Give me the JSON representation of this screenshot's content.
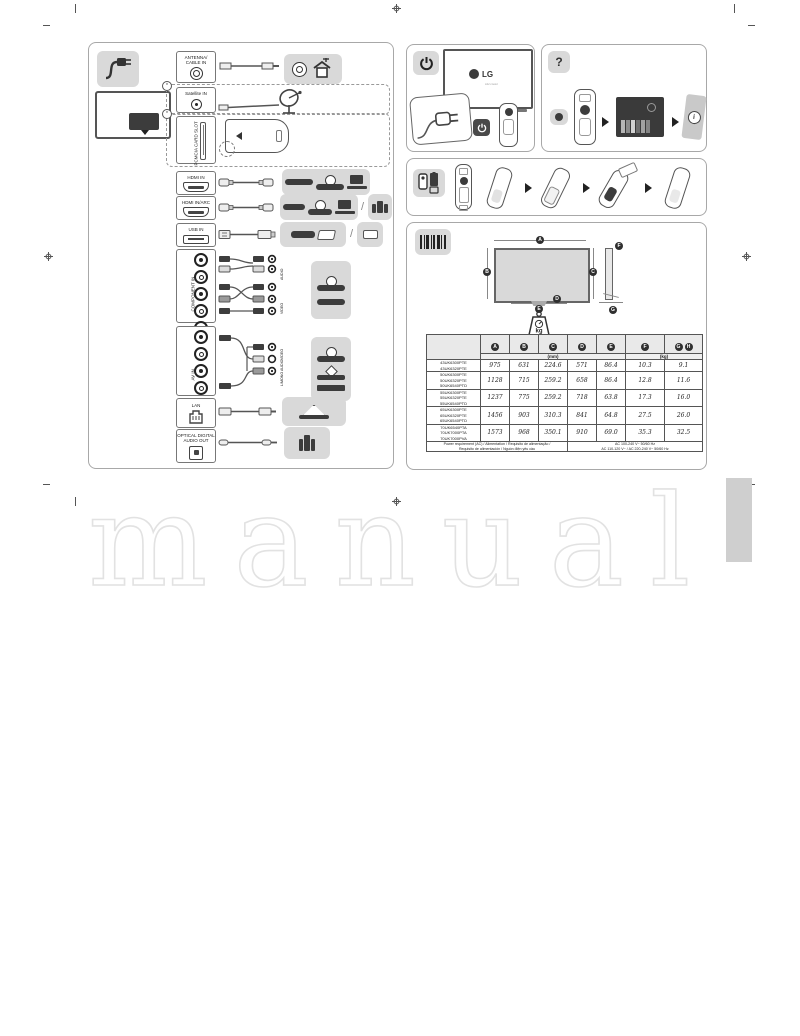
{
  "page": {
    "watermark_text": "manual"
  },
  "left_panel": {
    "ports": {
      "antenna": {
        "label": "ANTENNA/\nCABLE IN"
      },
      "satellite": {
        "label": "Satellite IN"
      },
      "pcmcia": {
        "label": "PCMCIA CARD SLOT"
      },
      "hdmi": {
        "label": "HDMI IN"
      },
      "hdmi_arc": {
        "label": "HDMI IN/ARC"
      },
      "usb": {
        "label": "USB IN"
      },
      "component": {
        "label": "COMPONENT IN",
        "adapter_labels": [
          "AUDIO",
          "VIDEO"
        ]
      },
      "av": {
        "label": "AV IN",
        "adapter_labels": [
          "VIDEO",
          "L/MONO AUDIO"
        ]
      },
      "lan": {
        "label": "LAN"
      },
      "optical": {
        "label": "OPTICAL DIGITAL\nAUDIO OUT"
      }
    },
    "optional_markers": [
      "*",
      "*"
    ]
  },
  "right_panels": {
    "power": {
      "logo": "LG",
      "logo_sub": "Life's Good"
    },
    "help": {
      "icon_label": "?",
      "info_label": "i"
    },
    "dimensions": {
      "weight_unit": "kg",
      "diagram_letters": {
        "front": [
          "A",
          "B",
          "C",
          "D",
          "E"
        ],
        "side": [
          "F",
          "G"
        ]
      },
      "table": {
        "headers": [
          [
            "A"
          ],
          [
            "B"
          ],
          [
            "C"
          ],
          [
            "D"
          ],
          [
            "E"
          ],
          [
            "F"
          ],
          [
            "G",
            "H"
          ]
        ],
        "units": {
          "mm": "(mm)",
          "kg": "(kg)"
        },
        "rows": [
          {
            "models": "43UK6300PTE\n43UK6320PTE",
            "values": [
              "975",
              "631",
              "224.6",
              "571",
              "86.4",
              "10.3",
              "9.1"
            ]
          },
          {
            "models": "50UK6300PTE\n50UK6320PTE\n50UK6540PTD",
            "values": [
              "1128",
              "715",
              "259.2",
              "658",
              "86.4",
              "12.8",
              "11.6"
            ]
          },
          {
            "models": "55UK6300PTE\n55UK6320PTE\n55UK6540PTD",
            "values": [
              "1237",
              "775",
              "259.2",
              "718",
              "63.8",
              "17.3",
              "16.0"
            ]
          },
          {
            "models": "65UK6300PTE\n65UK6320PTE\n65UK6540PTD",
            "values": [
              "1456",
              "903",
              "310.3",
              "841",
              "64.8",
              "27.5",
              "26.0"
            ]
          },
          {
            "models": "70UK6540PTA\n70UK7000PTA\n70UK7000PVA",
            "values": [
              "1573",
              "968",
              "350.1",
              "910",
              "69.0",
              "35.3",
              "32.5"
            ]
          }
        ],
        "power_label": "Power requirement (AC) / Alimentation / Requisito de alimentação /\nRequisito de alimentación / Nguồn điện yêu cầu",
        "power_value": "AC 100-240 V~ 50/60 Hz\nAC 110-120 V~ / AC 220-240 V~ 50/60 Hz"
      }
    }
  }
}
